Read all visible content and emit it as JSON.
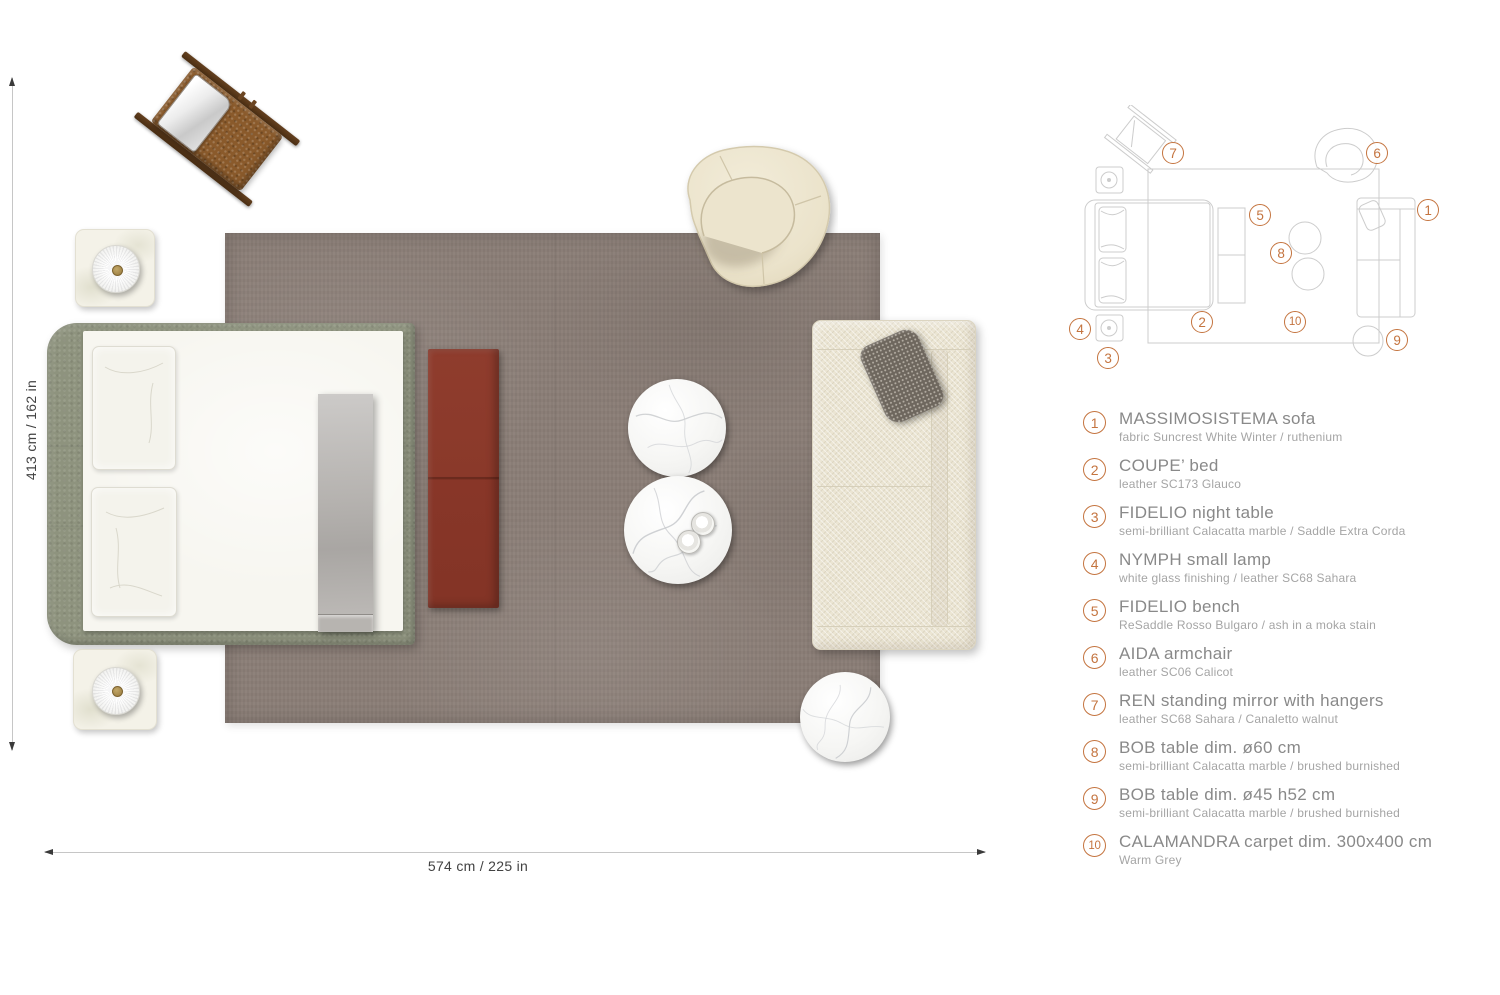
{
  "plan": {
    "dim_vertical": "413 cm / 162 in",
    "dim_horizontal": "574 cm / 225 in"
  },
  "schematic": {
    "markers": [
      {
        "label": "1"
      },
      {
        "label": "2"
      },
      {
        "label": "3"
      },
      {
        "label": "4"
      },
      {
        "label": "5"
      },
      {
        "label": "6"
      },
      {
        "label": "7"
      },
      {
        "label": "8"
      },
      {
        "label": "9"
      },
      {
        "label": "10"
      }
    ]
  },
  "legend": {
    "items": [
      {
        "num": "1",
        "title": "MASSIMOSISTEMA sofa",
        "subtitle": "fabric Suncrest White Winter / ruthenium"
      },
      {
        "num": "2",
        "title": "COUPE’ bed",
        "subtitle": "leather SC173 Glauco"
      },
      {
        "num": "3",
        "title": "FIDELIO night table",
        "subtitle": "semi-brilliant Calacatta marble / Saddle Extra Corda"
      },
      {
        "num": "4",
        "title": "NYMPH small lamp",
        "subtitle": "white glass finishing / leather SC68 Sahara"
      },
      {
        "num": "5",
        "title": "FIDELIO bench",
        "subtitle": "ReSaddle Rosso Bulgaro / ash in a moka stain"
      },
      {
        "num": "6",
        "title": "AIDA armchair",
        "subtitle": "leather SC06 Calicot"
      },
      {
        "num": "7",
        "title": "REN standing mirror with hangers",
        "subtitle": "leather SC68 Sahara / Canaletto walnut"
      },
      {
        "num": "8",
        "title": "BOB table dim. ø60 cm",
        "subtitle": "semi-brilliant Calacatta marble / brushed burnished"
      },
      {
        "num": "9",
        "title": "BOB table dim. ø45 h52 cm",
        "subtitle": "semi-brilliant Calacatta marble / brushed burnished"
      },
      {
        "num": "10",
        "title": "CALAMANDRA carpet dim. 300x400 cm",
        "subtitle": "Warm Grey"
      }
    ]
  },
  "colors": {
    "accent_orange": "#c4743f",
    "carpet_warm_grey": "#8a7d76",
    "bed_leather_glauco": "#8e937e",
    "bench_rosso_bulgaro": "#8e3b2b",
    "sofa_white_winter": "#ebe5d3",
    "armchair_calicot": "#ece4cd",
    "mirror_leather_sahara": "#8a5a2b",
    "marble_white": "#fafaf8",
    "schematic_line": "#cccccc",
    "legend_title_grey": "#898989",
    "legend_subtitle_grey": "#a5a5a5"
  }
}
